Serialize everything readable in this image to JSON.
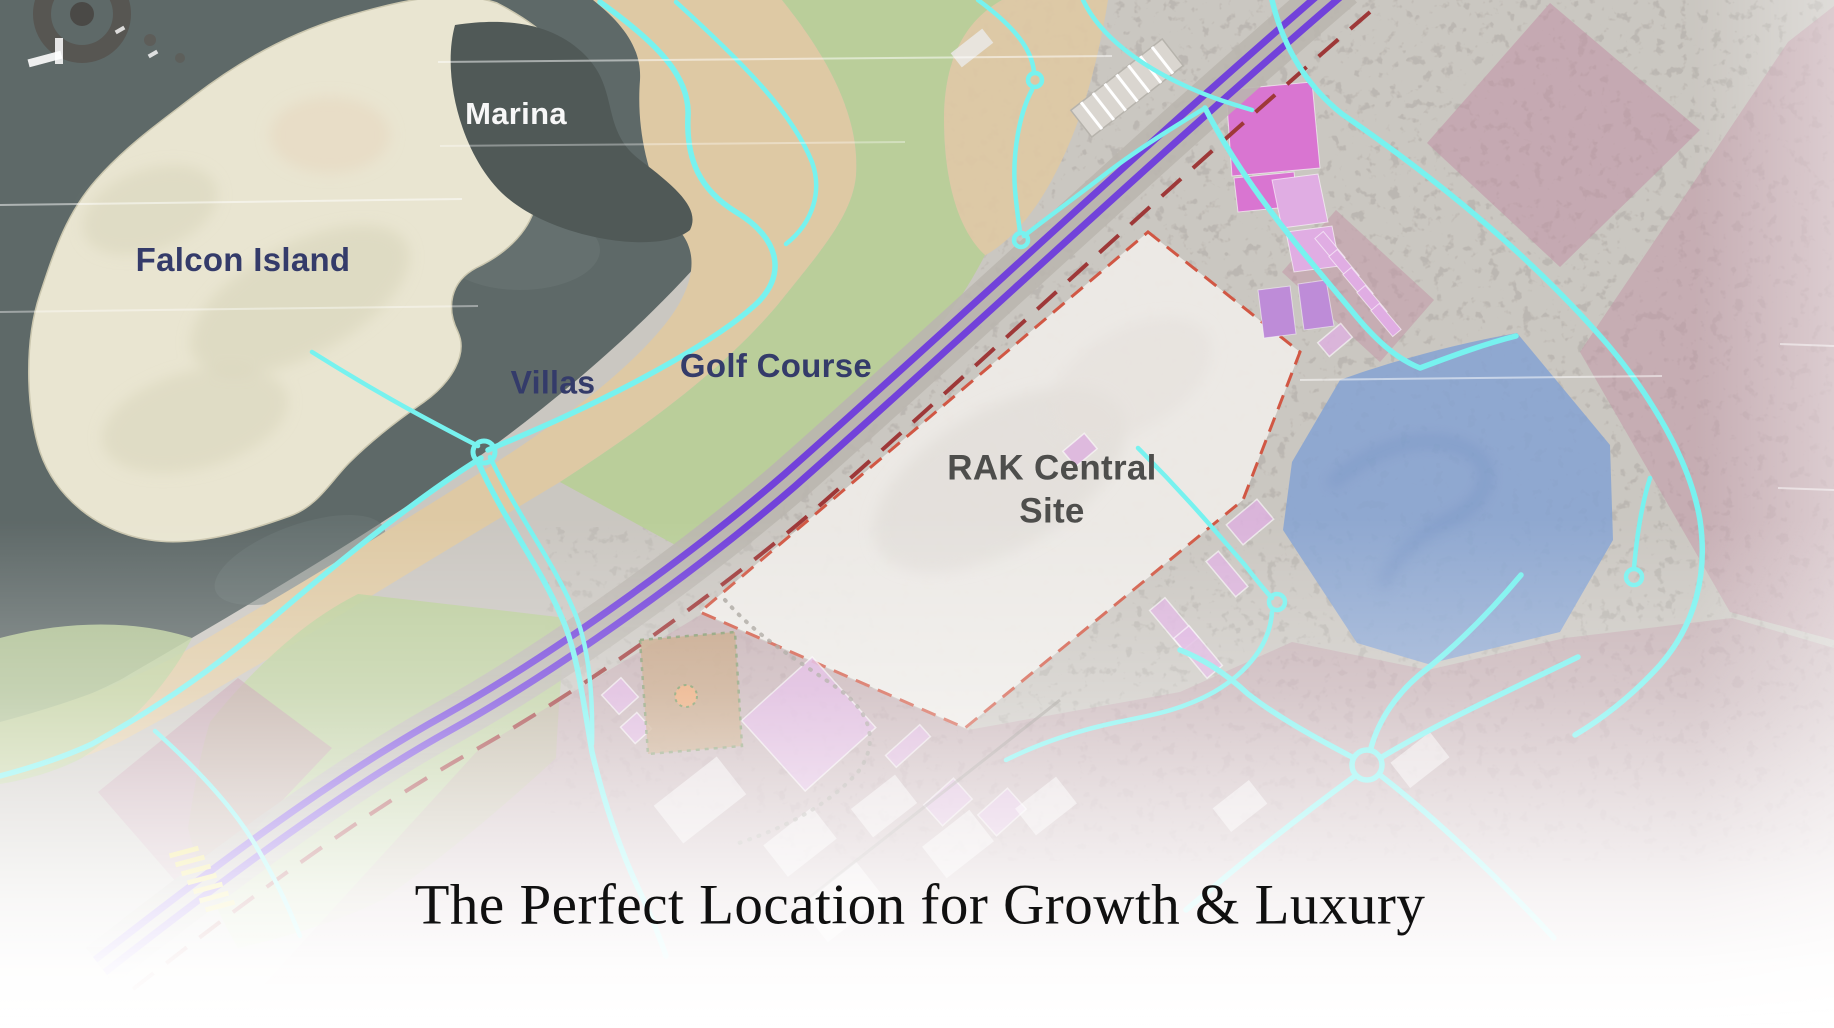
{
  "page": {
    "caption": "The Perfect Location for Growth & Luxury"
  },
  "map": {
    "labels": {
      "marina": "Marina",
      "falcon_island": "Falcon Island",
      "villas": "Villas",
      "golf_course": "Golf Course",
      "rak_central_line1": "RAK Central",
      "rak_central_line2": "Site"
    }
  },
  "colors": {
    "water": "#566160",
    "water_lite": "#64716f",
    "water_deep": "#47514f",
    "island": "#e8e4cf",
    "island_shade": "#d6d1b5",
    "shore": "#ddc7a0",
    "golf": "#b7cc95",
    "desert": "#c8c4be",
    "site_fill": "#edeae6",
    "site_stroke": "#cf4f3a",
    "boundary_red": "#992e2e",
    "highway_purple": "#6b38d8",
    "roadbed": "#b7b2ab",
    "road_cyan": "#70f2ef",
    "rose": "#bd8da0",
    "magenta": "#d76ecf",
    "magenta_lite": "#dfa9e2",
    "violet": "#bb86d6",
    "pink_parcel": "#dcaede",
    "blue_zone": "#7d9ed2",
    "yellow": "#e9da4f",
    "label_navy": "#2a3163",
    "label_white": "#f7f7f7",
    "label_grey": "#454543",
    "caption_ink": "#101010"
  }
}
